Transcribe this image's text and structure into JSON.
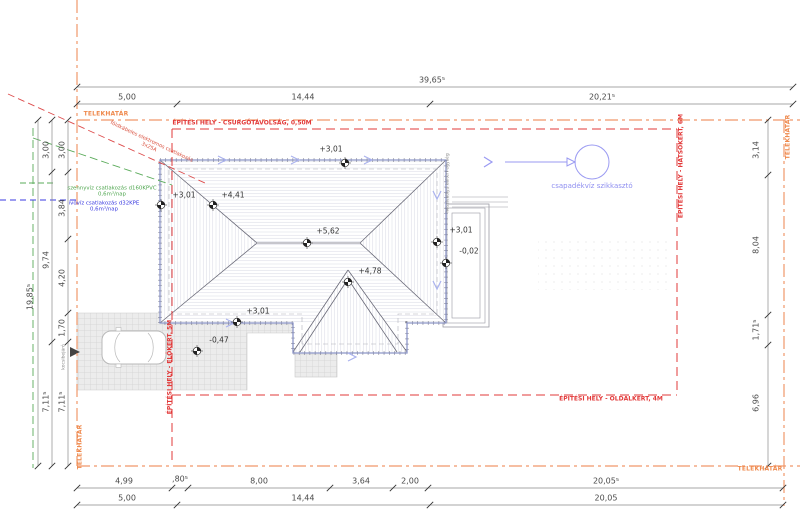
{
  "boundary": {
    "label": "TELEKHATÁR",
    "color": "#ef8a4e"
  },
  "envelope": {
    "color": "#e23a3a",
    "top": "ÉPÍTÉSI HELY - CSURGÓTÁVOLSÁG, 0,50M",
    "right": "ÉPÍTÉSI HELY - HÁTSÓKERT, 6M",
    "bottom": "ÉPÍTÉSI HELY - OLDALKERT, 4M",
    "left": "ÉPÍTÉSI HELY - ELŐKERT, 5M"
  },
  "utilities": {
    "electric": {
      "label": "földkábeles elektromos csatlakozás",
      "detail": "3x25A",
      "color": "#d94f3d"
    },
    "sewer": {
      "label": "szennyvíz csatlakozás d160KPVC",
      "detail": "0,6m³/nap",
      "color": "#4fa64f"
    },
    "water": {
      "label": "ivóvíz csatlakozás d32KPE",
      "detail": "0,6m³/nap",
      "color": "#3a3ae0"
    },
    "stormwater": {
      "label": "csapadékvíz szikkasztó",
      "color": "#8f8ff0"
    }
  },
  "equipment": {
    "heat_pump": "hőszivattyú kültéri egység"
  },
  "entry": {
    "label": "kocsibejáró"
  },
  "levels": {
    "eave_top": "+3,01",
    "eave_left": "+3,01",
    "ridge_west": "+4,41",
    "ridge_main": "+5,62",
    "ridge_south": "+4,78",
    "eave_bottom": "+3,01",
    "driveway": "-0,47",
    "eave_right": "+3,01",
    "terrace": "-0,02"
  },
  "dims": {
    "top_overall": "39,65⁵",
    "top": [
      "5,00",
      "14,44",
      "20,21⁵"
    ],
    "bottom_upper": [
      "4,99",
      ",80⁵",
      "8,00",
      "3,64",
      "2,00",
      "20,05⁵"
    ],
    "bottom_lower": [
      "5,00",
      "14,44",
      "20,05"
    ],
    "left_overall": "19,85⁵",
    "left_outer": [
      "3,00",
      "9,74",
      "7,11⁵"
    ],
    "left_inner": [
      "3,00",
      "3,84",
      "4,20",
      "1,70",
      "7,11⁵"
    ],
    "right": [
      "3,14",
      "8,04",
      "1,71⁵",
      "6,96"
    ]
  }
}
